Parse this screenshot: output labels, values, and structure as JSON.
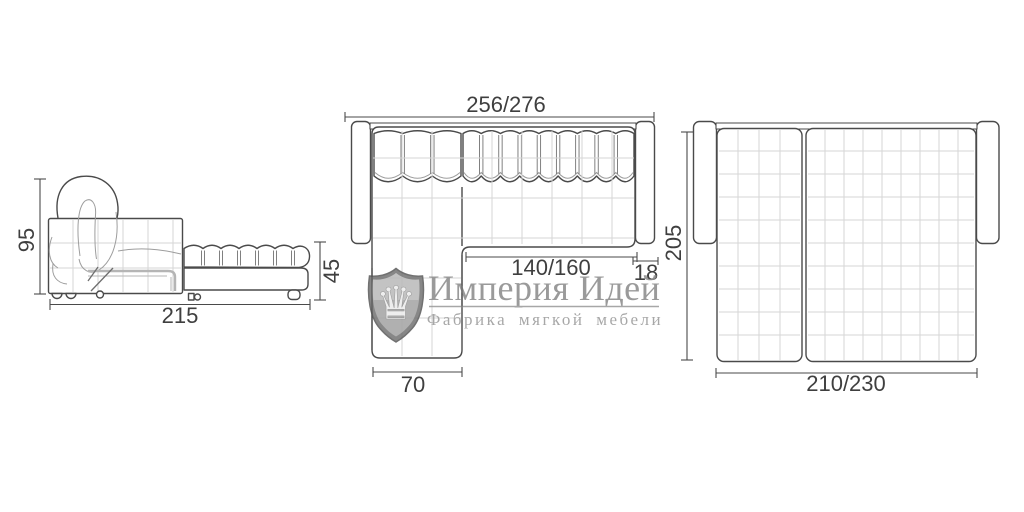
{
  "views": {
    "side": {
      "dims": {
        "height": "95",
        "length": "215",
        "seat_height": "45"
      }
    },
    "top": {
      "dims": {
        "total_width": "256/276",
        "seat_width": "140/160",
        "armrest_width": "18",
        "chaise_width": "70"
      }
    },
    "bed": {
      "dims": {
        "depth": "205",
        "bed_width": "210/230"
      }
    }
  },
  "watermark": {
    "brand": "Империя Идей",
    "tagline": "Фабрика мягкой мебели",
    "logo": "crown-shield"
  },
  "colors": {
    "background": "#ffffff",
    "line": "#4a4a4a",
    "grid": "#d5d5d5",
    "dimension_text": "#3f3f3f",
    "watermark_text": "#8d8d8d"
  }
}
